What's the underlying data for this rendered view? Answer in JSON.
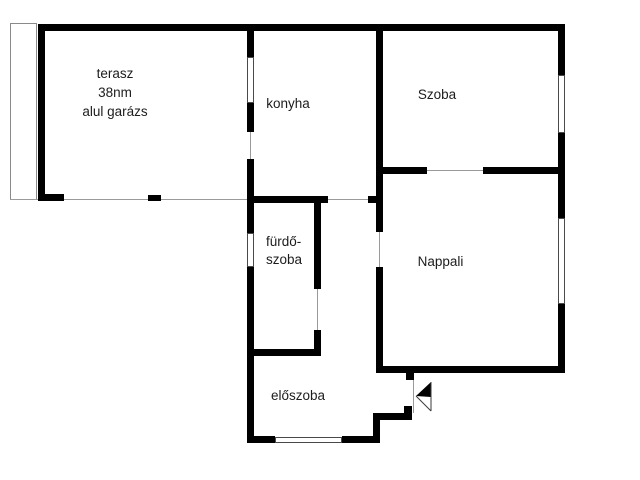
{
  "diagram_type": "floor-plan",
  "rooms": {
    "terasz": {
      "name": "terasz",
      "area": "38nm",
      "note": "alul garázs"
    },
    "konyha": {
      "name": "konyha"
    },
    "szoba": {
      "name": "Szoba"
    },
    "furdoszoba": {
      "name_line1": "fürdő-",
      "name_line2": "szoba"
    },
    "nappali": {
      "name": "Nappali"
    },
    "eloszoba": {
      "name": "előszoba"
    }
  },
  "colors": {
    "wall": "#000000",
    "thin_line": "#9a9a9a",
    "window_border": "#4a4a4a",
    "background": "#ffffff",
    "text": "#1c1c1c"
  },
  "plan": {
    "walls": [
      {
        "name": "outer-top-wall",
        "x": 38,
        "y": 24,
        "w": 527,
        "h": 7
      },
      {
        "name": "terasz-left-wall",
        "x": 38,
        "y": 24,
        "w": 7,
        "h": 176
      },
      {
        "name": "terasz-bottom-stub-left",
        "x": 38,
        "y": 194,
        "w": 26,
        "h": 7
      },
      {
        "name": "terasz-bottom-stub-mid",
        "x": 148,
        "y": 195,
        "w": 13,
        "h": 6
      },
      {
        "name": "terasz-konyha-wall-upper",
        "x": 247,
        "y": 24,
        "w": 7,
        "h": 33
      },
      {
        "name": "terasz-konyha-wall-mid",
        "x": 247,
        "y": 103,
        "w": 7,
        "h": 29
      },
      {
        "name": "terasz-konyha-wall-lower",
        "x": 247,
        "y": 159,
        "w": 7,
        "h": 74
      },
      {
        "name": "furdo-eloszoba-left-wall",
        "x": 247,
        "y": 267,
        "w": 7,
        "h": 176
      },
      {
        "name": "konyha-szoba-divider-wall",
        "x": 376,
        "y": 24,
        "w": 7,
        "h": 208
      },
      {
        "name": "nappali-left-wall-lower",
        "x": 376,
        "y": 267,
        "w": 7,
        "h": 106
      },
      {
        "name": "szoba-bottom-wall-left",
        "x": 376,
        "y": 167,
        "w": 51,
        "h": 7
      },
      {
        "name": "szoba-bottom-wall-right",
        "x": 483,
        "y": 167,
        "w": 82,
        "h": 7
      },
      {
        "name": "outer-right-wall-upper",
        "x": 558,
        "y": 24,
        "w": 7,
        "h": 51
      },
      {
        "name": "outer-right-wall-mid",
        "x": 558,
        "y": 133,
        "w": 7,
        "h": 85
      },
      {
        "name": "outer-right-wall-lower",
        "x": 558,
        "y": 304,
        "w": 7,
        "h": 69
      },
      {
        "name": "konyha-bottom-wall-left",
        "x": 247,
        "y": 196,
        "w": 81,
        "h": 7
      },
      {
        "name": "konyha-bottom-wall-right",
        "x": 368,
        "y": 196,
        "w": 8,
        "h": 7
      },
      {
        "name": "furdo-right-wall-upper",
        "x": 314,
        "y": 196,
        "w": 7,
        "h": 93
      },
      {
        "name": "furdo-right-wall-lower",
        "x": 314,
        "y": 330,
        "w": 7,
        "h": 26
      },
      {
        "name": "furdo-bottom-wall",
        "x": 247,
        "y": 349,
        "w": 74,
        "h": 7
      },
      {
        "name": "eloszoba-bottom-wall-left",
        "x": 247,
        "y": 436,
        "w": 28,
        "h": 7
      },
      {
        "name": "eloszoba-bottom-wall-right",
        "x": 342,
        "y": 436,
        "w": 38,
        "h": 7
      },
      {
        "name": "nappali-bottom-wall",
        "x": 376,
        "y": 366,
        "w": 189,
        "h": 7
      },
      {
        "name": "entry-door-jamb-top",
        "x": 406,
        "y": 373,
        "w": 8,
        "h": 7
      },
      {
        "name": "entry-lower-wall",
        "x": 373,
        "y": 413,
        "w": 39,
        "h": 7
      },
      {
        "name": "entry-door-jamb-bottom",
        "x": 404,
        "y": 406,
        "w": 8,
        "h": 14
      },
      {
        "name": "entry-left-wall",
        "x": 373,
        "y": 413,
        "w": 7,
        "h": 30
      }
    ],
    "windows": [
      {
        "name": "konyha-terasz-window",
        "x": 247,
        "y": 57,
        "w": 7,
        "h": 46
      },
      {
        "name": "furdo-window",
        "x": 247,
        "y": 233,
        "w": 7,
        "h": 34
      },
      {
        "name": "szoba-window",
        "x": 558,
        "y": 75,
        "w": 7,
        "h": 58
      },
      {
        "name": "nappali-window",
        "x": 558,
        "y": 218,
        "w": 7,
        "h": 86
      },
      {
        "name": "eloszoba-window",
        "x": 275,
        "y": 437,
        "w": 67,
        "h": 6
      }
    ],
    "thin_lines": [
      {
        "name": "terasz-edge-line",
        "x": 10,
        "y": 199,
        "w": 237,
        "h": 1
      },
      {
        "name": "terasz-konyha-door-line",
        "x": 250,
        "y": 132,
        "w": 1,
        "h": 27
      },
      {
        "name": "konyha-door-line",
        "x": 328,
        "y": 199,
        "w": 40,
        "h": 1
      },
      {
        "name": "szoba-door-line",
        "x": 427,
        "y": 170,
        "w": 56,
        "h": 1
      },
      {
        "name": "nappali-door-line",
        "x": 379,
        "y": 232,
        "w": 1,
        "h": 35
      },
      {
        "name": "furdo-door-line",
        "x": 317,
        "y": 289,
        "w": 1,
        "h": 41
      },
      {
        "name": "entry-door-line",
        "x": 413,
        "y": 379,
        "w": 1,
        "h": 34
      }
    ],
    "outline_boxes": [
      {
        "name": "terasz-side-strip",
        "x": 10,
        "y": 23,
        "w": 27,
        "h": 177
      }
    ]
  }
}
